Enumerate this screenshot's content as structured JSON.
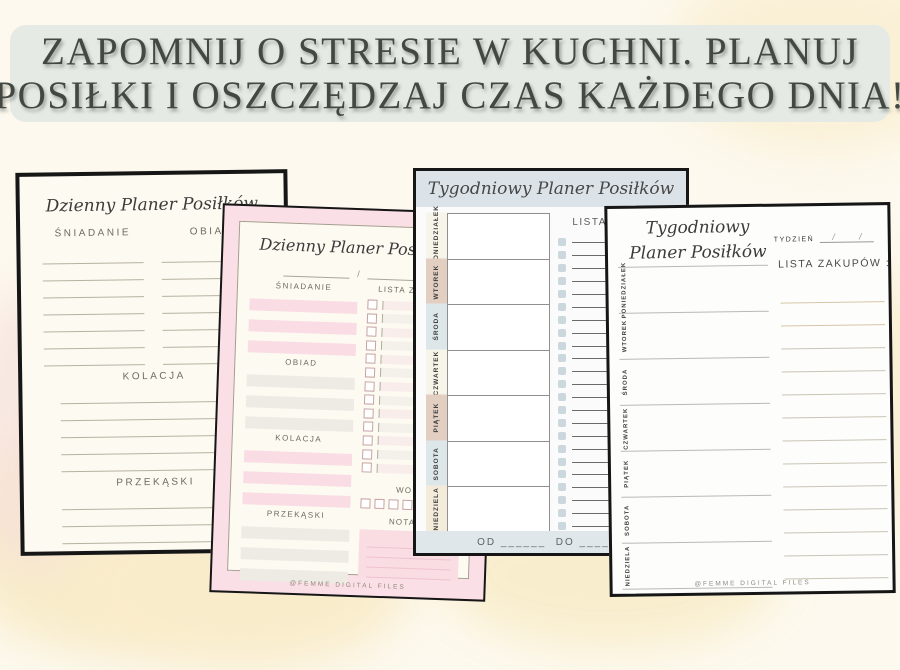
{
  "banner": {
    "line1": "ZAPOMNIJ O STRESIE W KUCHNI. PLANUJ",
    "line2": "POSIŁKI I OSZCZĘDZAJ CZAS KAŻDEGO DNIA!"
  },
  "pages": {
    "daily_white": {
      "title": "Dzienny Planer Posiłków",
      "columns": [
        "ŚNIADANIE",
        "OBIAD"
      ],
      "sections": [
        "KOLACJA",
        "PRZEKĄSKI"
      ]
    },
    "daily_pink": {
      "title": "Dzienny Planer Posiłków",
      "date_separator": "/",
      "sections": [
        "ŚNIADANIE",
        "OBIAD",
        "KOLACJA",
        "PRZEKĄSKI"
      ],
      "shopping_list_label": "LISTA ZAKUPÓW",
      "water_label": "WODA",
      "notes_label": "NOTATKI",
      "footer": "@FEMME DIGITAL FILES"
    },
    "weekly_blue": {
      "title": "Tygodniowy Planer Posiłków",
      "days": [
        "PONIEDZIAŁEK",
        "WTOREK",
        "ŚRODA",
        "CZWARTEK",
        "PIĄTEK",
        "SOBOTA",
        "NIEDZIELA"
      ],
      "shopping_list_label": "LISTA ZAKUPÓW",
      "date_range": "OD ______  DO ______"
    },
    "weekly_white": {
      "title_line1": "Tygodniowy",
      "title_line2": "Planer Posiłków",
      "week_label": "TYDZIEŃ",
      "week_slash": "/",
      "shopping_list_label": "LISTA ZAKUPÓW :",
      "days": [
        "PONIEDZIAŁEK",
        "WTOREK",
        "ŚRODA",
        "CZWARTEK",
        "PIĄTEK",
        "SOBOTA",
        "NIEDZIELA"
      ],
      "footer": "@FEMME DIGITAL FILES"
    }
  },
  "colors": {
    "banner_bg": "#e5eae4",
    "banner_text": "#434843",
    "background_cream": "#fdf9ee",
    "watercolor_yellow": "#f8ecca",
    "watercolor_pink": "#f6dfdc",
    "pink_page": "#fbdfe6",
    "pink_stripe": "#fadde4",
    "gray_stripe": "#edebe4",
    "weekly_header_blue": "#dce3e8",
    "weekly_band_blue": "#dfe7ea",
    "day_tab_tan": "#e3cfc1",
    "day_tab_blue": "#dde7ea",
    "day_tab_ivory": "#f7f4ea",
    "checkbox_blue": "#cbd8de"
  }
}
